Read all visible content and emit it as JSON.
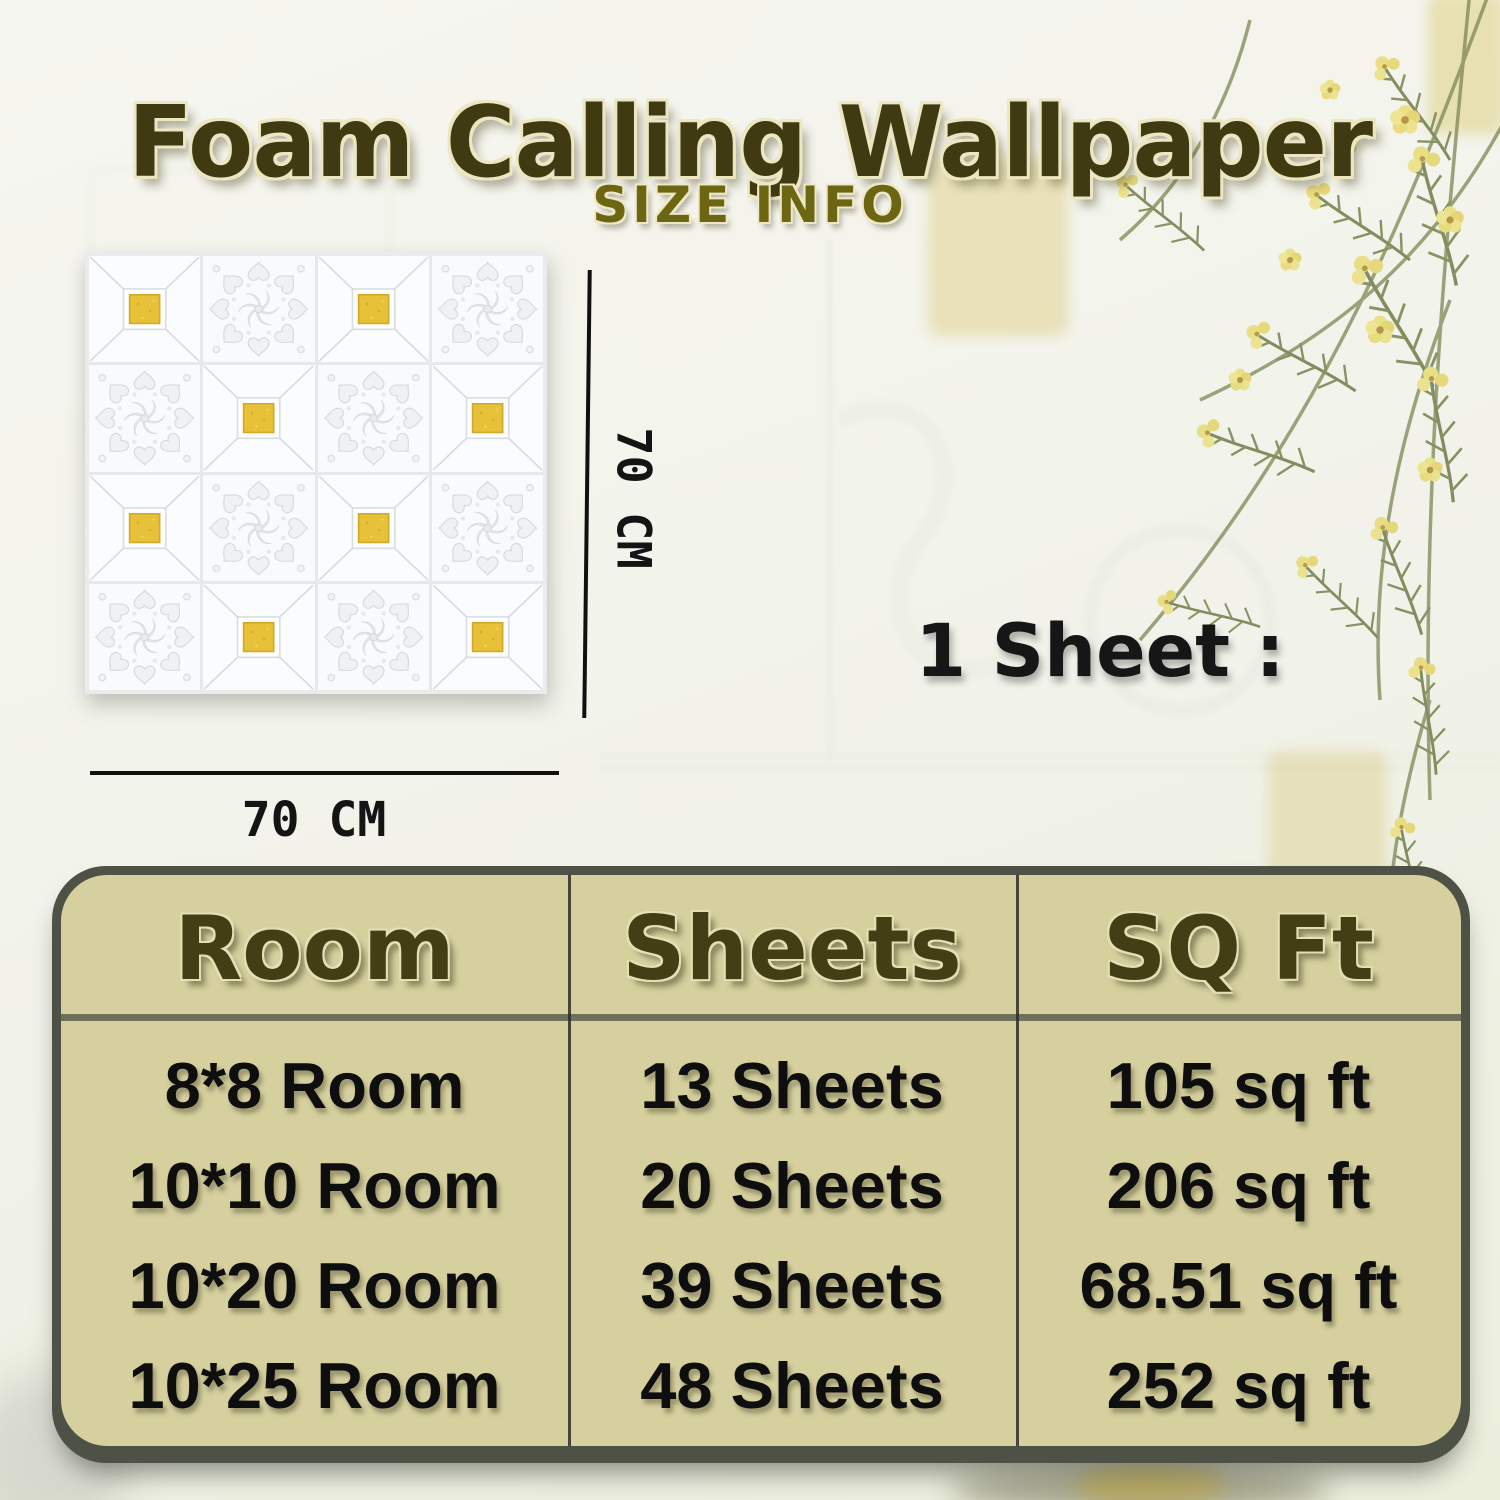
{
  "title": "Foam Calling Wallpaper",
  "subtitle": "SIZE INFO",
  "panel": {
    "vertical_dim_label": "70 CM",
    "horizontal_dim_label": "70 CM",
    "grid": [
      [
        "gold",
        "floral",
        "gold",
        "floral"
      ],
      [
        "floral",
        "gold",
        "floral",
        "gold"
      ],
      [
        "gold",
        "floral",
        "gold",
        "floral"
      ],
      [
        "floral",
        "gold",
        "floral",
        "gold"
      ]
    ]
  },
  "sheet_info": {
    "line1": "1 Sheet :",
    "line2": "70*70=  5.24",
    "line3": "Sq Feet"
  },
  "table": {
    "headers": [
      "Room",
      "Sheets",
      "SQ Ft"
    ],
    "rows": [
      [
        "8*8 Room",
        "13 Sheets",
        "105 sq ft"
      ],
      [
        "10*10 Room",
        "20 Sheets",
        "206 sq ft"
      ],
      [
        "10*20 Room",
        "39 Sheets",
        "68.51 sq ft"
      ],
      [
        "10*25 Room",
        "48 Sheets",
        "252 sq ft"
      ]
    ]
  },
  "colors": {
    "title_text": "#3f3a11",
    "subtitle_text": "#6c6613",
    "table_background": "#d6d09f",
    "table_frame": "#4e5146",
    "header_text": "#443e14",
    "body_text": "#0e0e0e",
    "gold_accent": "#e7c239"
  }
}
